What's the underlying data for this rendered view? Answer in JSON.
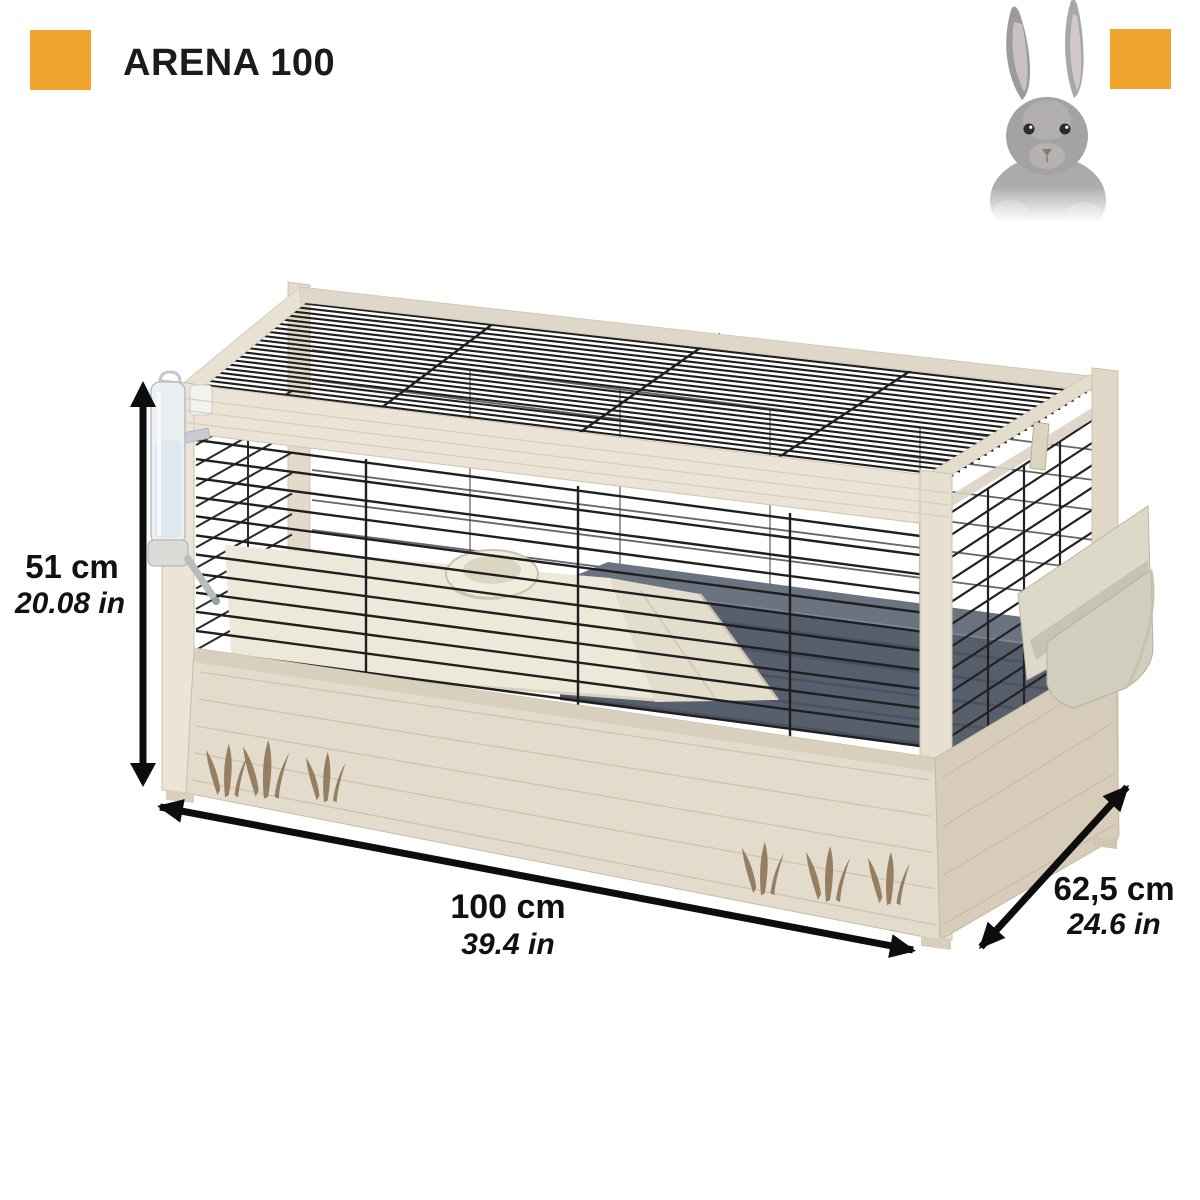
{
  "header": {
    "title": "ARENA 100",
    "accent_color": "#F0A42E",
    "text_color": "#1a1a1a"
  },
  "hero": {
    "animal": "grey rabbit"
  },
  "dimensions": {
    "height": {
      "metric": "51 cm",
      "imperial": "20.08 in"
    },
    "width": {
      "metric": "100 cm",
      "imperial": "39.4 in"
    },
    "depth": {
      "metric": "62,5 cm",
      "imperial": "24.6 in"
    }
  }
}
